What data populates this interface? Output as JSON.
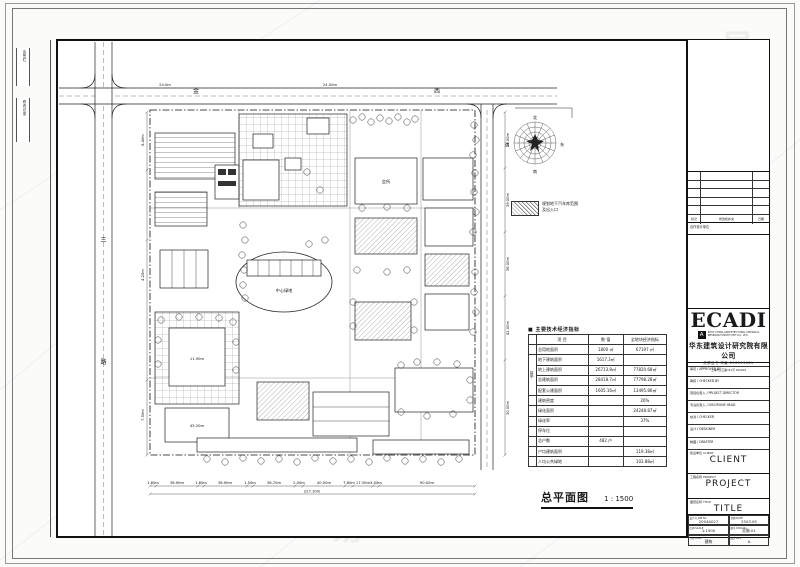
{
  "watermark": {
    "glyph": "易"
  },
  "sheet": {
    "margin_note_top": "会签栏",
    "margin_note_bottom": "修改记录"
  },
  "roads": {
    "top_name_char_1": "金",
    "top_name_char_2": "西",
    "left_name_char_1": "三",
    "left_name_char_2": "路"
  },
  "dims": {
    "top": [
      "24.0m",
      "24.00m"
    ],
    "bottom": [
      "1.60m",
      "36.90m",
      "1.60m",
      "36.90m",
      "1.50m",
      "36.70m",
      "2.00m",
      "40.00m",
      "7.80m",
      "17.30m",
      "5.00m",
      "90.00m"
    ],
    "bottom_total": "227.10m",
    "left": [
      "8.40m",
      "4.20m",
      "7.50m"
    ],
    "right": [
      "24.00m",
      "39.00m",
      "36.00m",
      "42.00m",
      "30.00m"
    ]
  },
  "wind_rose": {
    "n": "北",
    "e": "东",
    "s": "南",
    "w": "西"
  },
  "legend": {
    "line1": "规划地下汽车库范围",
    "line2": "及出入口"
  },
  "plan": {
    "center_green": "中心绿地",
    "club": "会所",
    "height_1": "11.90m",
    "height_2": "45.20m"
  },
  "stats": {
    "title": "■ 主要技术经济指标",
    "side": "其中",
    "headers": [
      "项  目",
      "数  值",
      "全地块经济指标"
    ],
    "rows": [
      [
        "总用地面积",
        "1800 ㎡",
        "67197 ㎡"
      ],
      [
        "地下建筑面积",
        "1617.3㎡",
        ""
      ],
      [
        "地上建筑面积",
        "26713.8㎡",
        "77820.68㎡"
      ],
      [
        "总建筑面积",
        "28418.7㎡",
        "77798.28㎡"
      ],
      [
        "配套公建面积",
        "1605.16㎡",
        "13495.86㎡"
      ],
      [
        "建筑密度",
        "",
        "26%"
      ],
      [
        "绿化面积",
        "",
        "24248.87㎡"
      ],
      [
        "绿化率",
        "",
        "37%"
      ],
      [
        "停车位",
        "",
        ""
      ],
      [
        "总户数",
        "482 户",
        ""
      ],
      [
        "户均建筑面积",
        "",
        "119.38㎡"
      ],
      [
        "人均公共绿地",
        "",
        "102.88㎡"
      ]
    ]
  },
  "drawing_title": {
    "name": "总平面图",
    "scale": "1 : 1500"
  },
  "titleblock": {
    "revision": {
      "mark": "标记",
      "desc": "修改和补充",
      "date": "日期"
    },
    "coop": "合作设计单位",
    "logo": {
      "name": "ECADI",
      "mark": "A",
      "en1": "EAST CHINA ARCHITECTURAL DESIGN &",
      "en2": "RESEARCH INSTITUTE CO., LTD.",
      "cn": "华东建筑设计研究院有限公司",
      "cert": "资质证书 甲级 090101081",
      "addr": "上海市汉口路151号 200002"
    },
    "fields": [
      "审定 / APPROVED BY",
      "审核 / CHECKED BY",
      "项目负责人 / PROJECT DIRECTOR",
      "专业负责人 / DISCIPLINE HEAD",
      "校对 / CHECKER",
      "设计 / DESIGNER",
      "制图 / DRAFTER"
    ],
    "client": {
      "label": "建设单位 CLIENT",
      "value": "CLIENT"
    },
    "project": {
      "label": "工程名称 PROJECT",
      "value": "PROJECT"
    },
    "title": {
      "label": "图纸名称 TITLE",
      "value": "TITLE"
    },
    "grid": [
      {
        "label": "设计号 JOB No.",
        "value": "2004A027"
      },
      {
        "label": "日期 DATE",
        "value": "2503.05"
      },
      {
        "label": "比例 SCALE",
        "value": "1:1500"
      },
      {
        "label": "图号 DWG No.",
        "value": "总施-01"
      },
      {
        "label": "专业 DISC.",
        "value": "建筑"
      },
      {
        "label": "版次 REV.",
        "value": "A"
      }
    ]
  }
}
